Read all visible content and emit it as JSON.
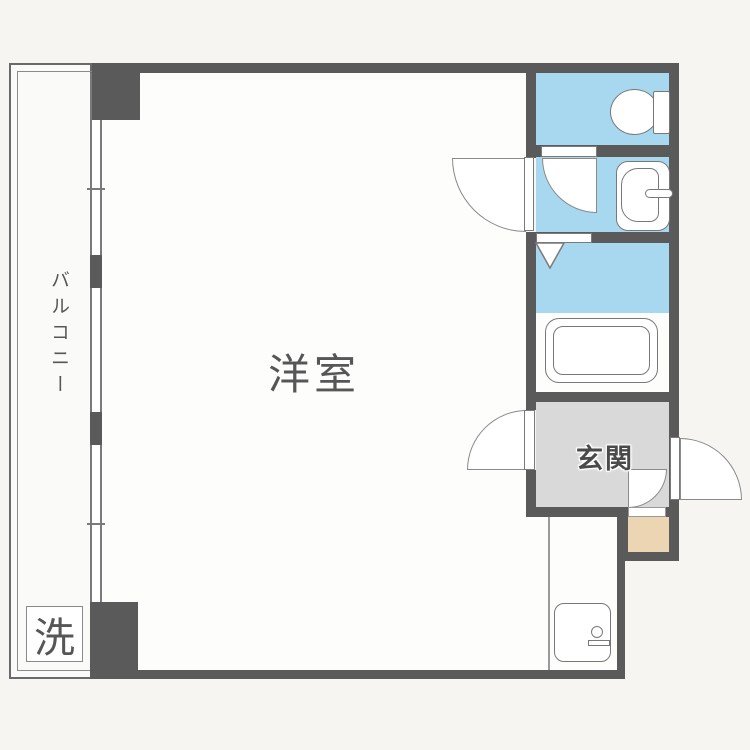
{
  "floorplan": {
    "labels": {
      "main_room": "洋室",
      "balcony": "バルコニー",
      "entrance": "玄関",
      "washing_machine": "洗"
    },
    "colors": {
      "wall": "#5a5a5a",
      "wet_area_blue": "#a8d8f0",
      "entrance_floor_gray": "#d9d9d9",
      "storage_tan": "#ecd5b3",
      "room_floor": "#fdfdfb",
      "background": "#f6f5f1",
      "fixture_line": "#787878"
    },
    "fixtures": [
      "toilet",
      "washbasin",
      "bathtub",
      "kitchen-sink",
      "washing-machine-space",
      "sliding-windows",
      "swing-doors"
    ]
  }
}
